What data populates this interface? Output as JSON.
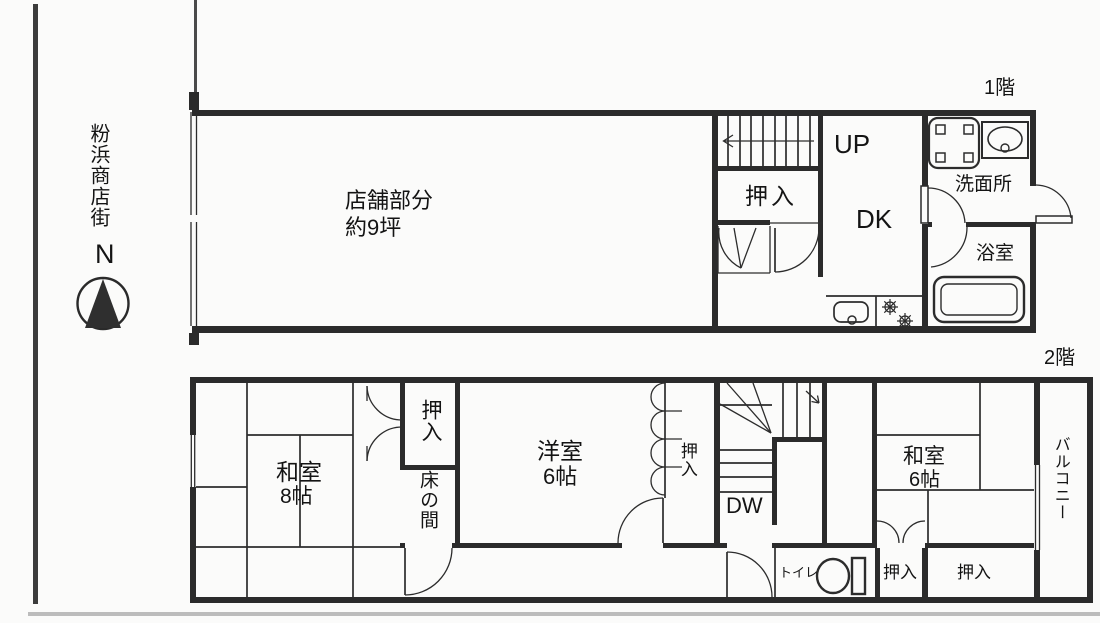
{
  "street": {
    "name": "粉浜商店街",
    "compass_label": "N"
  },
  "floor1": {
    "label": "1階",
    "store_line1": "店舗部分",
    "store_line2": "約9坪",
    "stairs_label": "UP",
    "closet": "押入",
    "dk": "DK",
    "washroom": "洗面所",
    "bath": "浴室"
  },
  "floor2": {
    "label": "2階",
    "washitsu8_line1": "和室",
    "washitsu8_line2": "8帖",
    "closet_ne": "押入",
    "tokonoma": "床の間",
    "yoshitsu_line1": "洋室",
    "yoshitsu_line2": "6帖",
    "closet_mid": "押入",
    "stairs_label": "DW",
    "washitsu6_line1": "和室",
    "washitsu6_line2": "6帖",
    "balcony": "バルコニー",
    "toilet": "トイレ",
    "closet_s1": "押入",
    "closet_s2": "押入"
  },
  "colors": {
    "line": "#2c2c2c",
    "scan_rule": "#bcbcbc"
  }
}
